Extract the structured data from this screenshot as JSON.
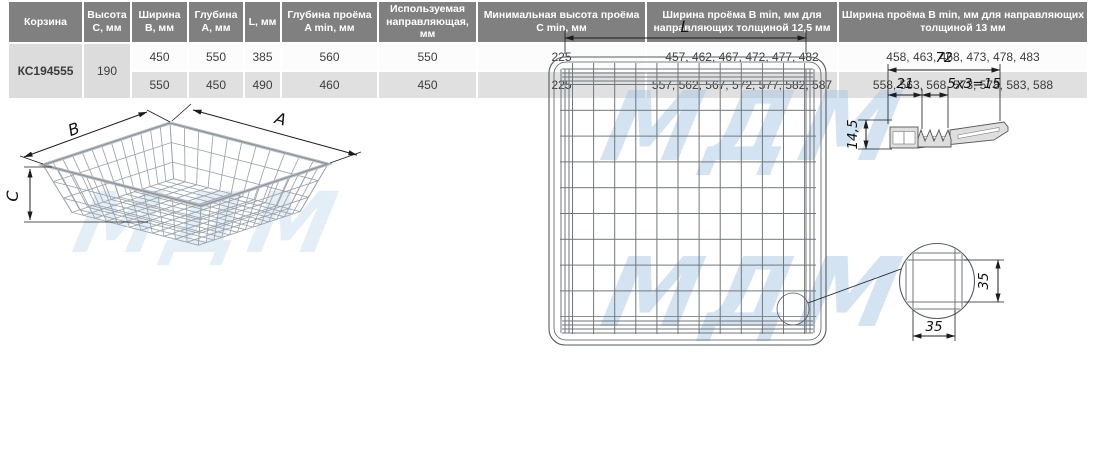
{
  "watermark": "МДМ",
  "drawings": {
    "isometric": {
      "label_a": "A",
      "label_b": "B",
      "label_c": "C"
    },
    "top_view": {
      "label_l": "L"
    },
    "hook_profile": {
      "total_width": "72",
      "offset": "21",
      "serration": "5x3=15",
      "height": "14,5"
    },
    "mesh_detail": {
      "cell_height": "35",
      "cell_width": "35"
    }
  },
  "table": {
    "headers": [
      "Корзина",
      "Высота C, мм",
      "Ширина B, мм",
      "Глубина A, мм",
      "L, мм",
      "Глубина проёма A min, мм",
      "Используемая направляющая, мм",
      "Минимальная высота проёма C min, мм",
      "Ширина проёма B min, мм для направляющих толщиной 12,5 мм",
      "Ширина проёма B min, мм для направляющих толщиной 13 мм"
    ],
    "basket_code": "КС194555",
    "height_c": "190",
    "rows": [
      [
        "450",
        "550",
        "385",
        "560",
        "550",
        "225",
        "457, 462, 467, 472, 477, 482",
        "458, 463, 468, 473, 478, 483"
      ],
      [
        "550",
        "450",
        "490",
        "460",
        "450",
        "225",
        "557, 562, 567, 572, 577, 582, 587",
        "558, 563, 568, 573, 578, 583, 588"
      ]
    ]
  }
}
